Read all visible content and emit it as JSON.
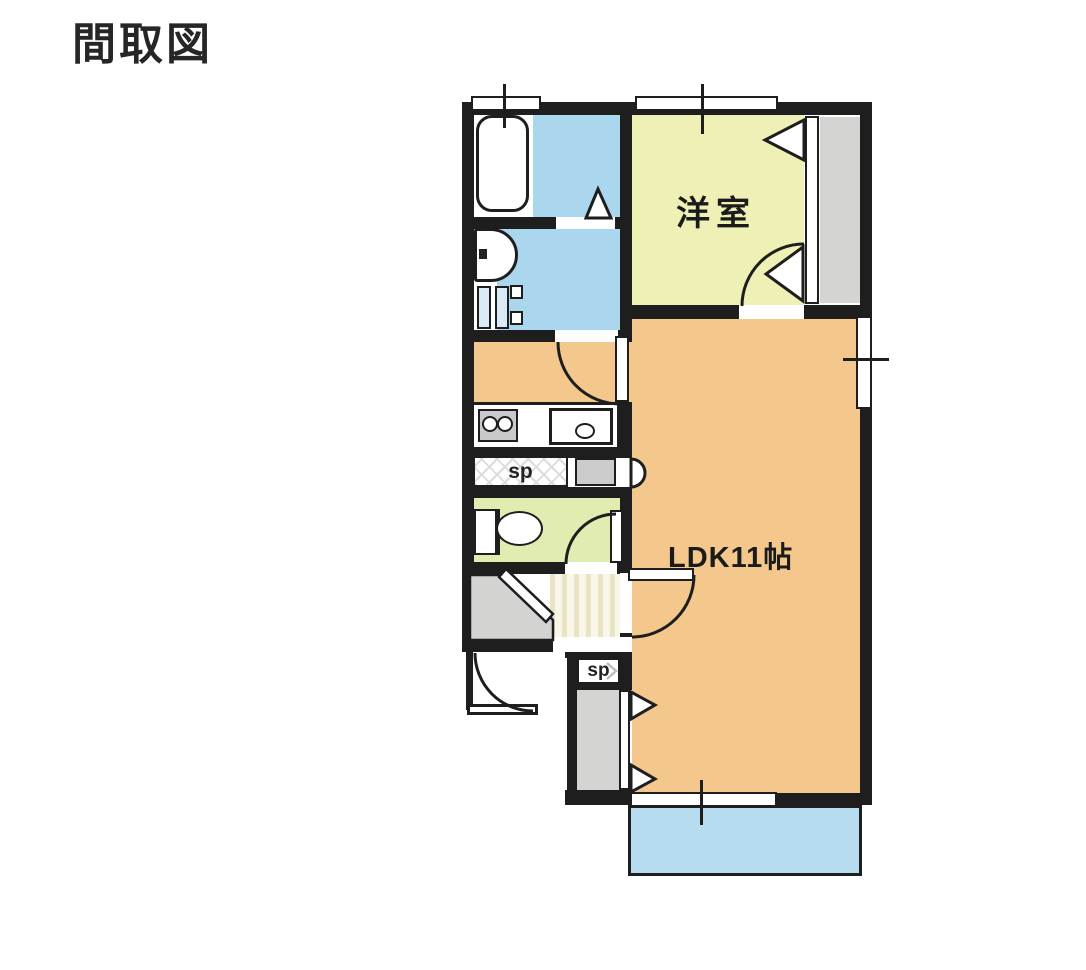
{
  "page_title": "間取図",
  "plan": {
    "room_labels": [
      {
        "name": "western-room",
        "text": "洋室"
      },
      {
        "name": "ldk",
        "text": "LDK11帖"
      }
    ],
    "sp_labels": {
      "upper": "sp",
      "lower": "sp"
    },
    "colors": {
      "wall": "#1e1e1e",
      "water_blue": "#aad6ee",
      "balcony_blue": "#b7dcef",
      "western_room_yellow": "#eff0b5",
      "ldk_orange": "#f4c78c",
      "toilet_green": "#e0ecb0",
      "closet_gray": "#d4d4d2",
      "stair_cream": "#f9f7ea"
    }
  }
}
